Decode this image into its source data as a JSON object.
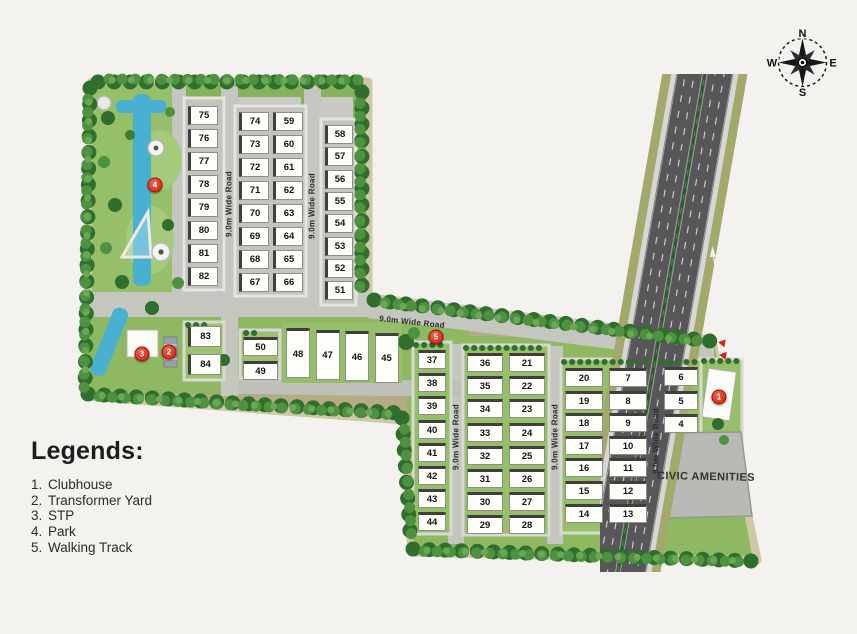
{
  "compass": {
    "n": "N",
    "e": "E",
    "s": "S",
    "w": "W"
  },
  "legends": {
    "heading": "Legends:",
    "items": [
      {
        "num": "1.",
        "label": "Clubhouse"
      },
      {
        "num": "2.",
        "label": "Transformer Yard"
      },
      {
        "num": "3.",
        "label": "STP"
      },
      {
        "num": "4.",
        "label": "Park"
      },
      {
        "num": "5.",
        "label": "Walking Track"
      }
    ]
  },
  "roads": {
    "wide_road_label": "9.0m Wide Road"
  },
  "highway": {
    "toward_up": "Towards Chikkanagate",
    "toward_down": "Towards Anekal",
    "exit_label": "EXIT",
    "entry_label": "ENTRY"
  },
  "civic_amenities_label": "CIVIC AMENITIES",
  "markers": [
    {
      "id": "1"
    },
    {
      "id": "2"
    },
    {
      "id": "3"
    },
    {
      "id": "4"
    },
    {
      "id": "5"
    }
  ],
  "plot_groups": {
    "colA": [
      "75",
      "76",
      "77",
      "78",
      "79",
      "80",
      "81",
      "82"
    ],
    "colB1": [
      "74",
      "73",
      "72",
      "71",
      "70",
      "69",
      "68",
      "67"
    ],
    "colB2": [
      "59",
      "60",
      "61",
      "62",
      "63",
      "64",
      "65",
      "66"
    ],
    "colC": [
      "58",
      "57",
      "56",
      "55",
      "54",
      "53",
      "52",
      "51"
    ],
    "col83": [
      "83",
      "84"
    ],
    "col50": [
      "50",
      "49"
    ],
    "row45": [
      "48",
      "47",
      "46",
      "45"
    ],
    "colD": [
      "37",
      "38",
      "39",
      "40",
      "41",
      "42",
      "43",
      "44"
    ],
    "colE1": [
      "36",
      "35",
      "34",
      "33",
      "32",
      "31",
      "30",
      "29"
    ],
    "colE2": [
      "21",
      "22",
      "23",
      "24",
      "25",
      "26",
      "27",
      "28"
    ],
    "colF1": [
      "20",
      "19",
      "18",
      "17",
      "16",
      "15",
      "14"
    ],
    "colF2": [
      "7",
      "8",
      "9",
      "10",
      "11",
      "12",
      "13"
    ],
    "colG": [
      "6",
      "5",
      "4"
    ]
  }
}
